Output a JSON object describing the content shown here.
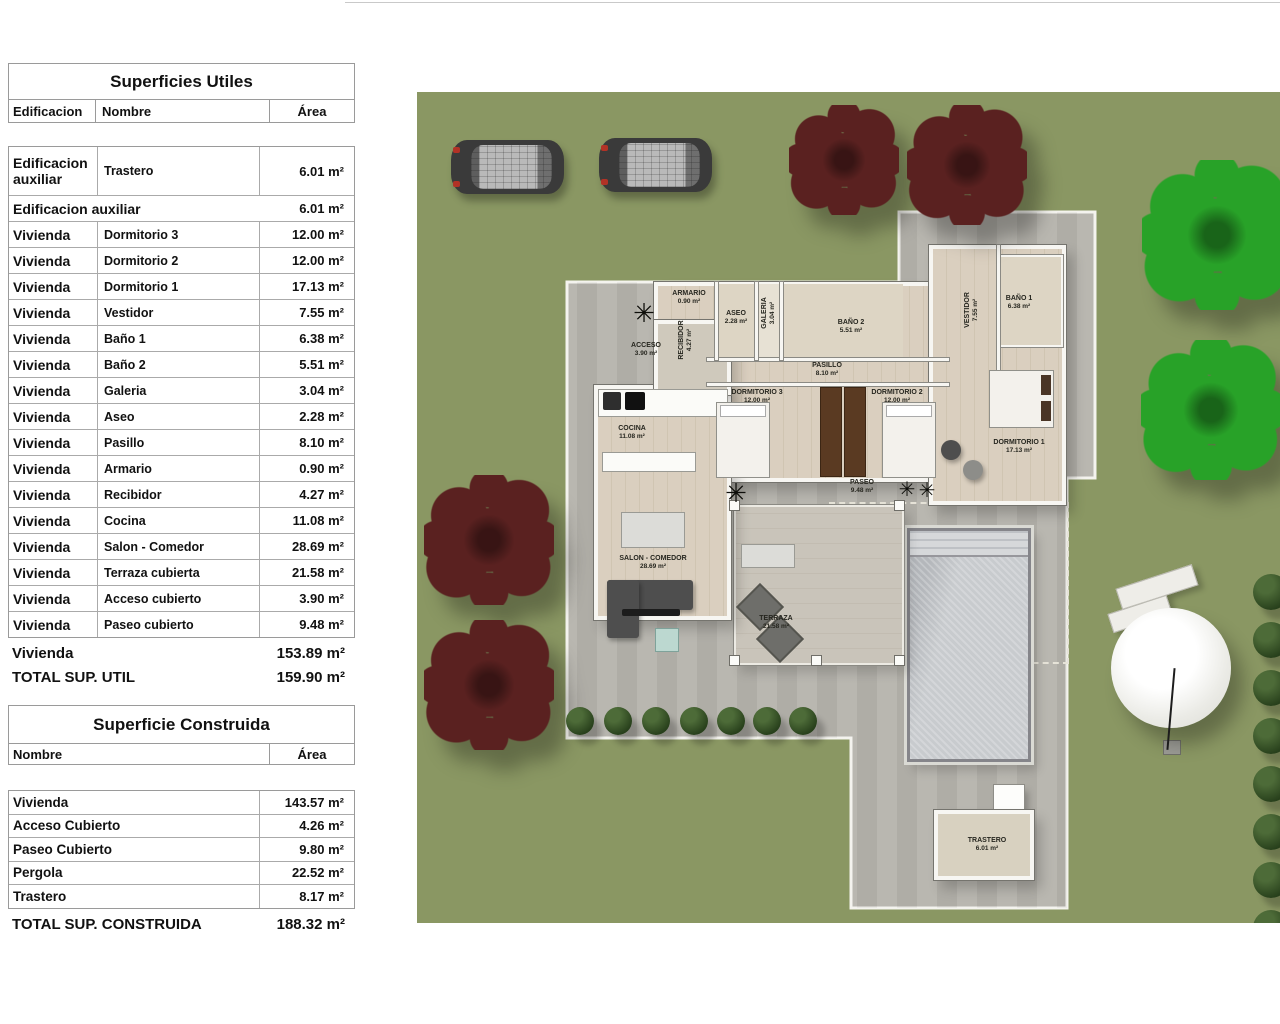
{
  "superficies_utiles": {
    "title": "Superficies Utiles",
    "col_edificacion": "Edificacion",
    "col_nombre": "Nombre",
    "col_area": "Área",
    "rows": [
      {
        "type": "data",
        "edificacion": "Edificacion auxiliar",
        "nombre": "Trastero",
        "area": "6.01 m²"
      },
      {
        "type": "subtotal",
        "label": "Edificacion auxiliar",
        "area": "6.01 m²"
      },
      {
        "type": "data",
        "edificacion": "Vivienda",
        "nombre": "Dormitorio 3",
        "area": "12.00 m²"
      },
      {
        "type": "data",
        "edificacion": "Vivienda",
        "nombre": "Dormitorio 2",
        "area": "12.00 m²"
      },
      {
        "type": "data",
        "edificacion": "Vivienda",
        "nombre": "Dormitorio 1",
        "area": "17.13 m²"
      },
      {
        "type": "data",
        "edificacion": "Vivienda",
        "nombre": "Vestidor",
        "area": "7.55 m²"
      },
      {
        "type": "data",
        "edificacion": "Vivienda",
        "nombre": "Baño 1",
        "area": "6.38 m²"
      },
      {
        "type": "data",
        "edificacion": "Vivienda",
        "nombre": "Baño 2",
        "area": "5.51 m²"
      },
      {
        "type": "data",
        "edificacion": "Vivienda",
        "nombre": "Galeria",
        "area": "3.04 m²"
      },
      {
        "type": "data",
        "edificacion": "Vivienda",
        "nombre": "Aseo",
        "area": "2.28 m²"
      },
      {
        "type": "data",
        "edificacion": "Vivienda",
        "nombre": "Pasillo",
        "area": "8.10 m²"
      },
      {
        "type": "data",
        "edificacion": "Vivienda",
        "nombre": "Armario",
        "area": "0.90 m²"
      },
      {
        "type": "data",
        "edificacion": "Vivienda",
        "nombre": "Recibidor",
        "area": "4.27 m²"
      },
      {
        "type": "data",
        "edificacion": "Vivienda",
        "nombre": "Cocina",
        "area": "11.08 m²"
      },
      {
        "type": "data",
        "edificacion": "Vivienda",
        "nombre": "Salon - Comedor",
        "area": "28.69 m²"
      },
      {
        "type": "data",
        "edificacion": "Vivienda",
        "nombre": "Terraza cubierta",
        "area": "21.58 m²"
      },
      {
        "type": "data",
        "edificacion": "Vivienda",
        "nombre": "Acceso cubierto",
        "area": "3.90 m²"
      },
      {
        "type": "data",
        "edificacion": "Vivienda",
        "nombre": "Paseo cubierto",
        "area": "9.48 m²"
      }
    ],
    "subtotal_vivienda": {
      "label": "Vivienda",
      "area": "153.89 m²"
    },
    "total": {
      "label": "TOTAL SUP. UTIL",
      "area": "159.90 m²"
    }
  },
  "superficie_construida": {
    "title": "Superficie Construida",
    "col_nombre": "Nombre",
    "col_area": "Área",
    "rows": [
      {
        "nombre": "Vivienda",
        "area": "143.57 m²"
      },
      {
        "nombre": "Acceso Cubierto",
        "area": "4.26 m²"
      },
      {
        "nombre": "Paseo Cubierto",
        "area": "9.80 m²"
      },
      {
        "nombre": "Pergola",
        "area": "22.52 m²"
      },
      {
        "nombre": "Trastero",
        "area": "8.17 m²"
      }
    ],
    "total": {
      "label": "TOTAL SUP. CONSTRUIDA",
      "area": "188.32 m²"
    }
  },
  "floorplan": {
    "icons": {
      "plant": "✳"
    },
    "colors": {
      "lawn": "#8a9763",
      "paving": "#b6b4ad",
      "tree_green": "#28a228",
      "tree_maroon": "#5a2120",
      "pool": "#c7cacd"
    },
    "rooms": [
      {
        "name": "ACCESO",
        "area": "3.90 m²"
      },
      {
        "name": "RECIBIDOR",
        "area": "4.27 m²"
      },
      {
        "name": "ARMARIO",
        "area": "0.90 m²"
      },
      {
        "name": "ASEO",
        "area": "2.28 m²"
      },
      {
        "name": "GALERIA",
        "area": "3.04 m²"
      },
      {
        "name": "BAÑO 2",
        "area": "5.51 m²"
      },
      {
        "name": "PASILLO",
        "area": "8.10 m²"
      },
      {
        "name": "DORMITORIO 3",
        "area": "12.00 m²"
      },
      {
        "name": "DORMITORIO 2",
        "area": "12.00 m²"
      },
      {
        "name": "VESTIDOR",
        "area": "7.55 m²"
      },
      {
        "name": "BAÑO 1",
        "area": "6.38 m²"
      },
      {
        "name": "DORMITORIO 1",
        "area": "17.13 m²"
      },
      {
        "name": "COCINA",
        "area": "11.08 m²"
      },
      {
        "name": "SALON - COMEDOR",
        "area": "28.69 m²"
      },
      {
        "name": "TERRAZA",
        "area": "21.58 m²"
      },
      {
        "name": "PASEO",
        "area": "9.48 m²"
      },
      {
        "name": "TRASTERO",
        "area": "6.01 m²"
      }
    ]
  }
}
